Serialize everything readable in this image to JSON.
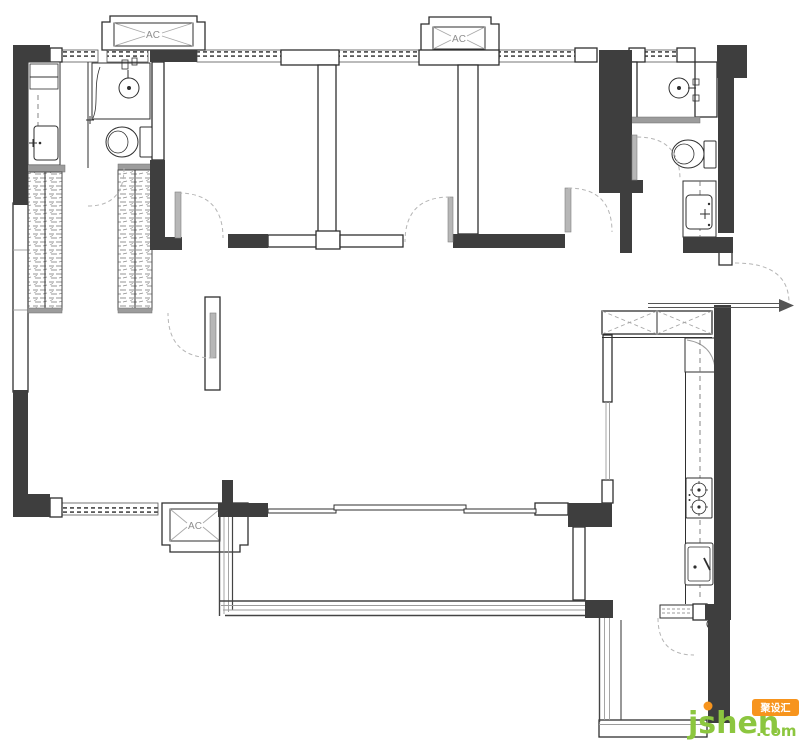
{
  "plan": {
    "kind": "residential-floor-plan",
    "ac_units": [
      {
        "id": "ac-top-left",
        "label": "AC"
      },
      {
        "id": "ac-top-middle",
        "label": "AC"
      },
      {
        "id": "ac-bottom-left",
        "label": "AC"
      }
    ],
    "fixtures": [
      "toilet-icon",
      "wall-basin-icon",
      "shower-curtain-icon",
      "vanity-sink-icon",
      "wardrobe-hatch-icon",
      "gas-stove-icon",
      "kitchen-sink-icon",
      "corner-cabinet-icon",
      "sliding-door-icon",
      "door-swing-arc-icon",
      "entry-door-arrow-icon",
      "floor-drain-icon",
      "window-dash-icon",
      "x-cabinet-icon"
    ]
  },
  "colors": {
    "background": "#FFFFFF",
    "wall_dark": "#3E3E3E",
    "outline": "#2F2F2F",
    "line_gray": "#9B9B9B",
    "door_leaf": "#B7B7B7",
    "arc_dash": "#B5B5B5",
    "brand_green": "#8CC63F",
    "accent_orange": "#F7941D"
  },
  "watermark": {
    "brand": "jsheh",
    "tld": ".com",
    "badge": "聚设汇"
  }
}
